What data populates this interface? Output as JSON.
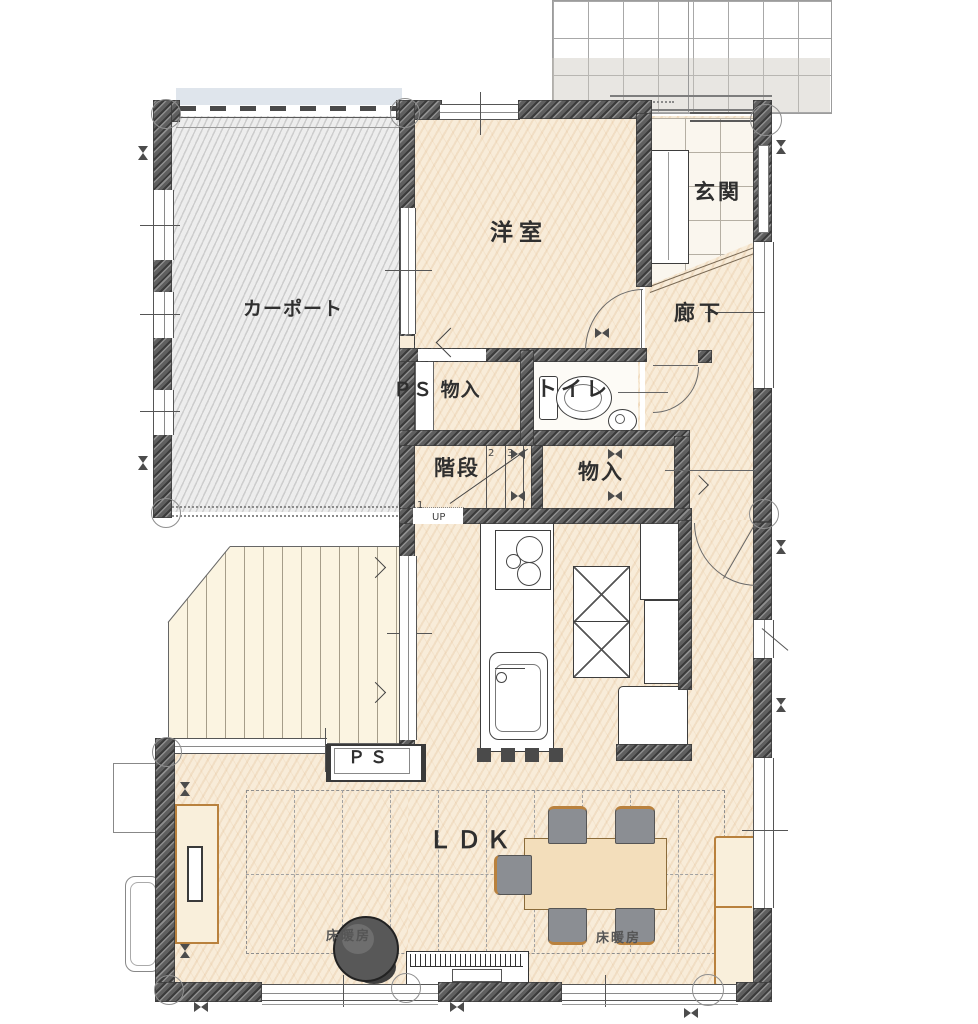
{
  "labels": {
    "carport": "カーポート",
    "western_room": "洋室",
    "entrance": "玄関",
    "hallway": "廊下",
    "ps_closet": "ＰＳ 物入",
    "toilet": "トイレ",
    "stairs": "階段",
    "closet": "物入",
    "ldk": "ＬＤＫ",
    "pipe_space": "ＰＳ",
    "floor_heating": "床暖房",
    "up": "UP",
    "step1": "1",
    "step2": "2",
    "step3": "3"
  },
  "colors": {
    "floor": "#f8ecd9",
    "wall": "#5f5f5f",
    "carport_floor": "#ededed",
    "deck": "#fbf4e1",
    "table_wood": "#f3debb",
    "wood_trim": "#b9813d",
    "chair_gray": "#8b8e93",
    "roof_band": "#dfe5ec"
  }
}
